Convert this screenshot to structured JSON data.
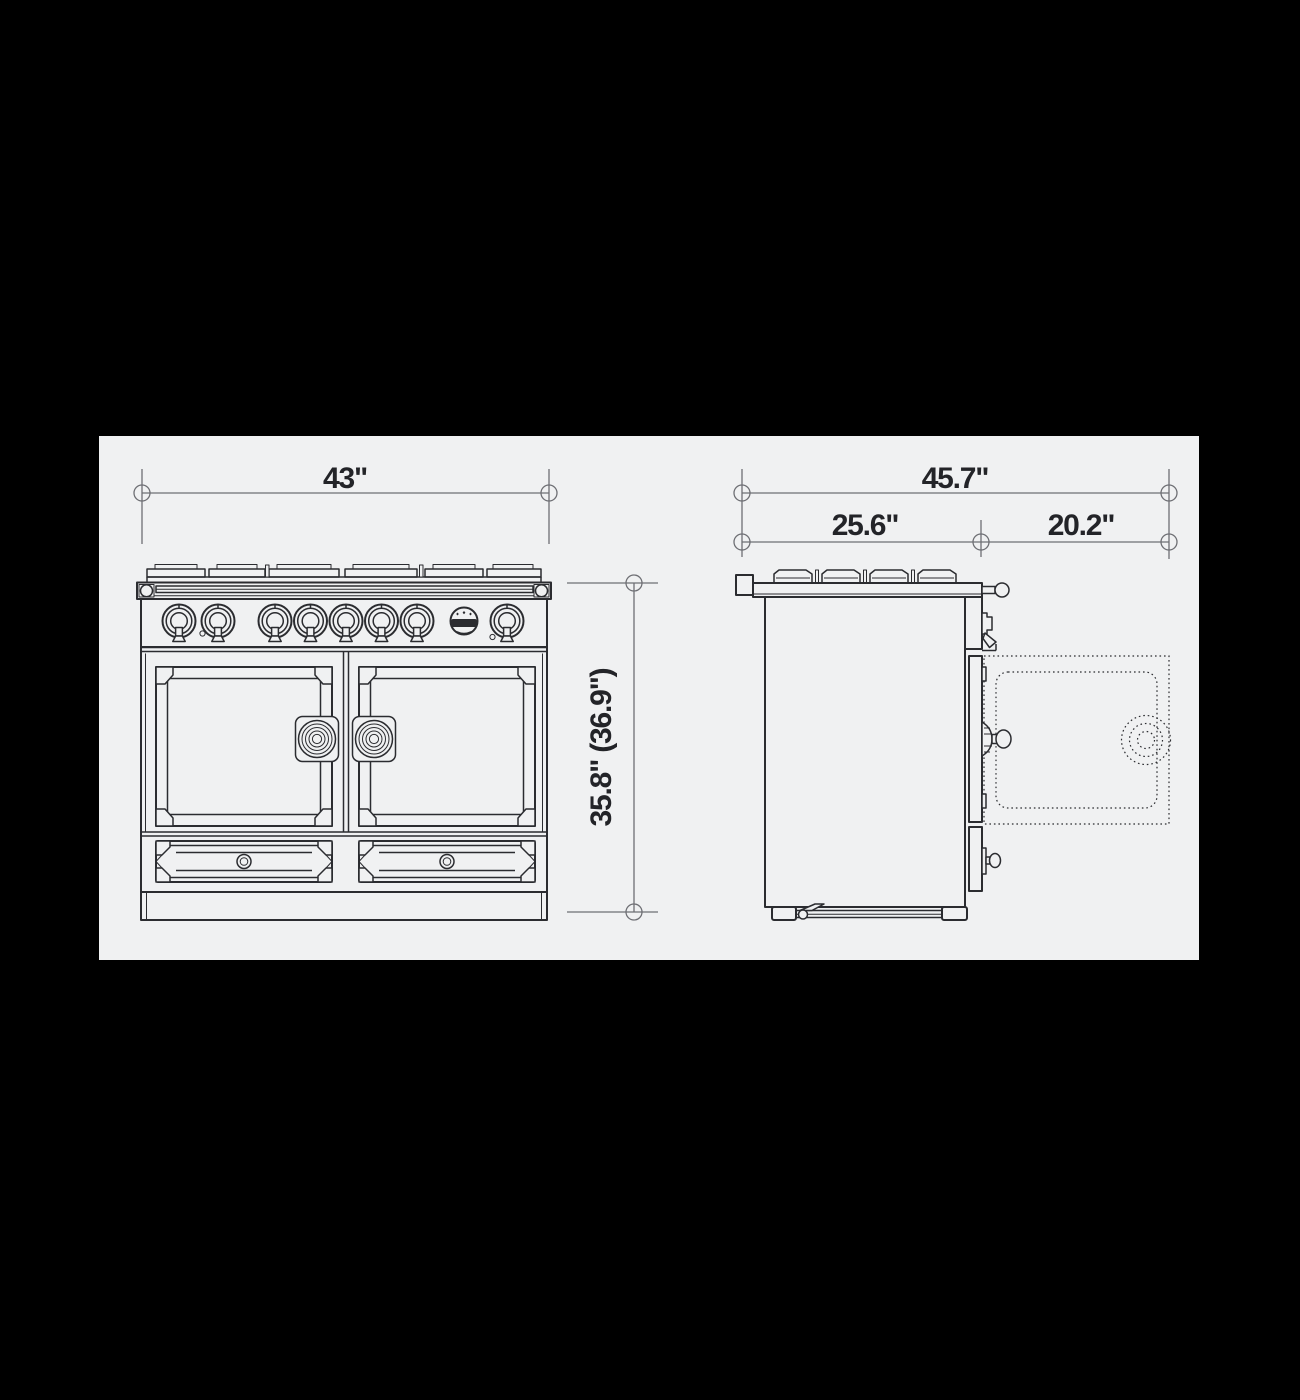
{
  "diagram": {
    "title": "range-dimension-drawing",
    "front_view": {
      "label_width": "43\"",
      "label_height": "35.8\" (36.9\")",
      "brand_badge_icon": "star-crest-logo",
      "burner_knob_count": 8
    },
    "side_view": {
      "label_total_depth": "45.7\"",
      "label_body_depth": "25.6\"",
      "label_door_open_depth": "20.2\""
    },
    "colors": {
      "canvas": "#000000",
      "panel": "#f0f1f2",
      "line": "#2b2c30",
      "dim": "#6e6f74",
      "text": "#232428"
    }
  }
}
